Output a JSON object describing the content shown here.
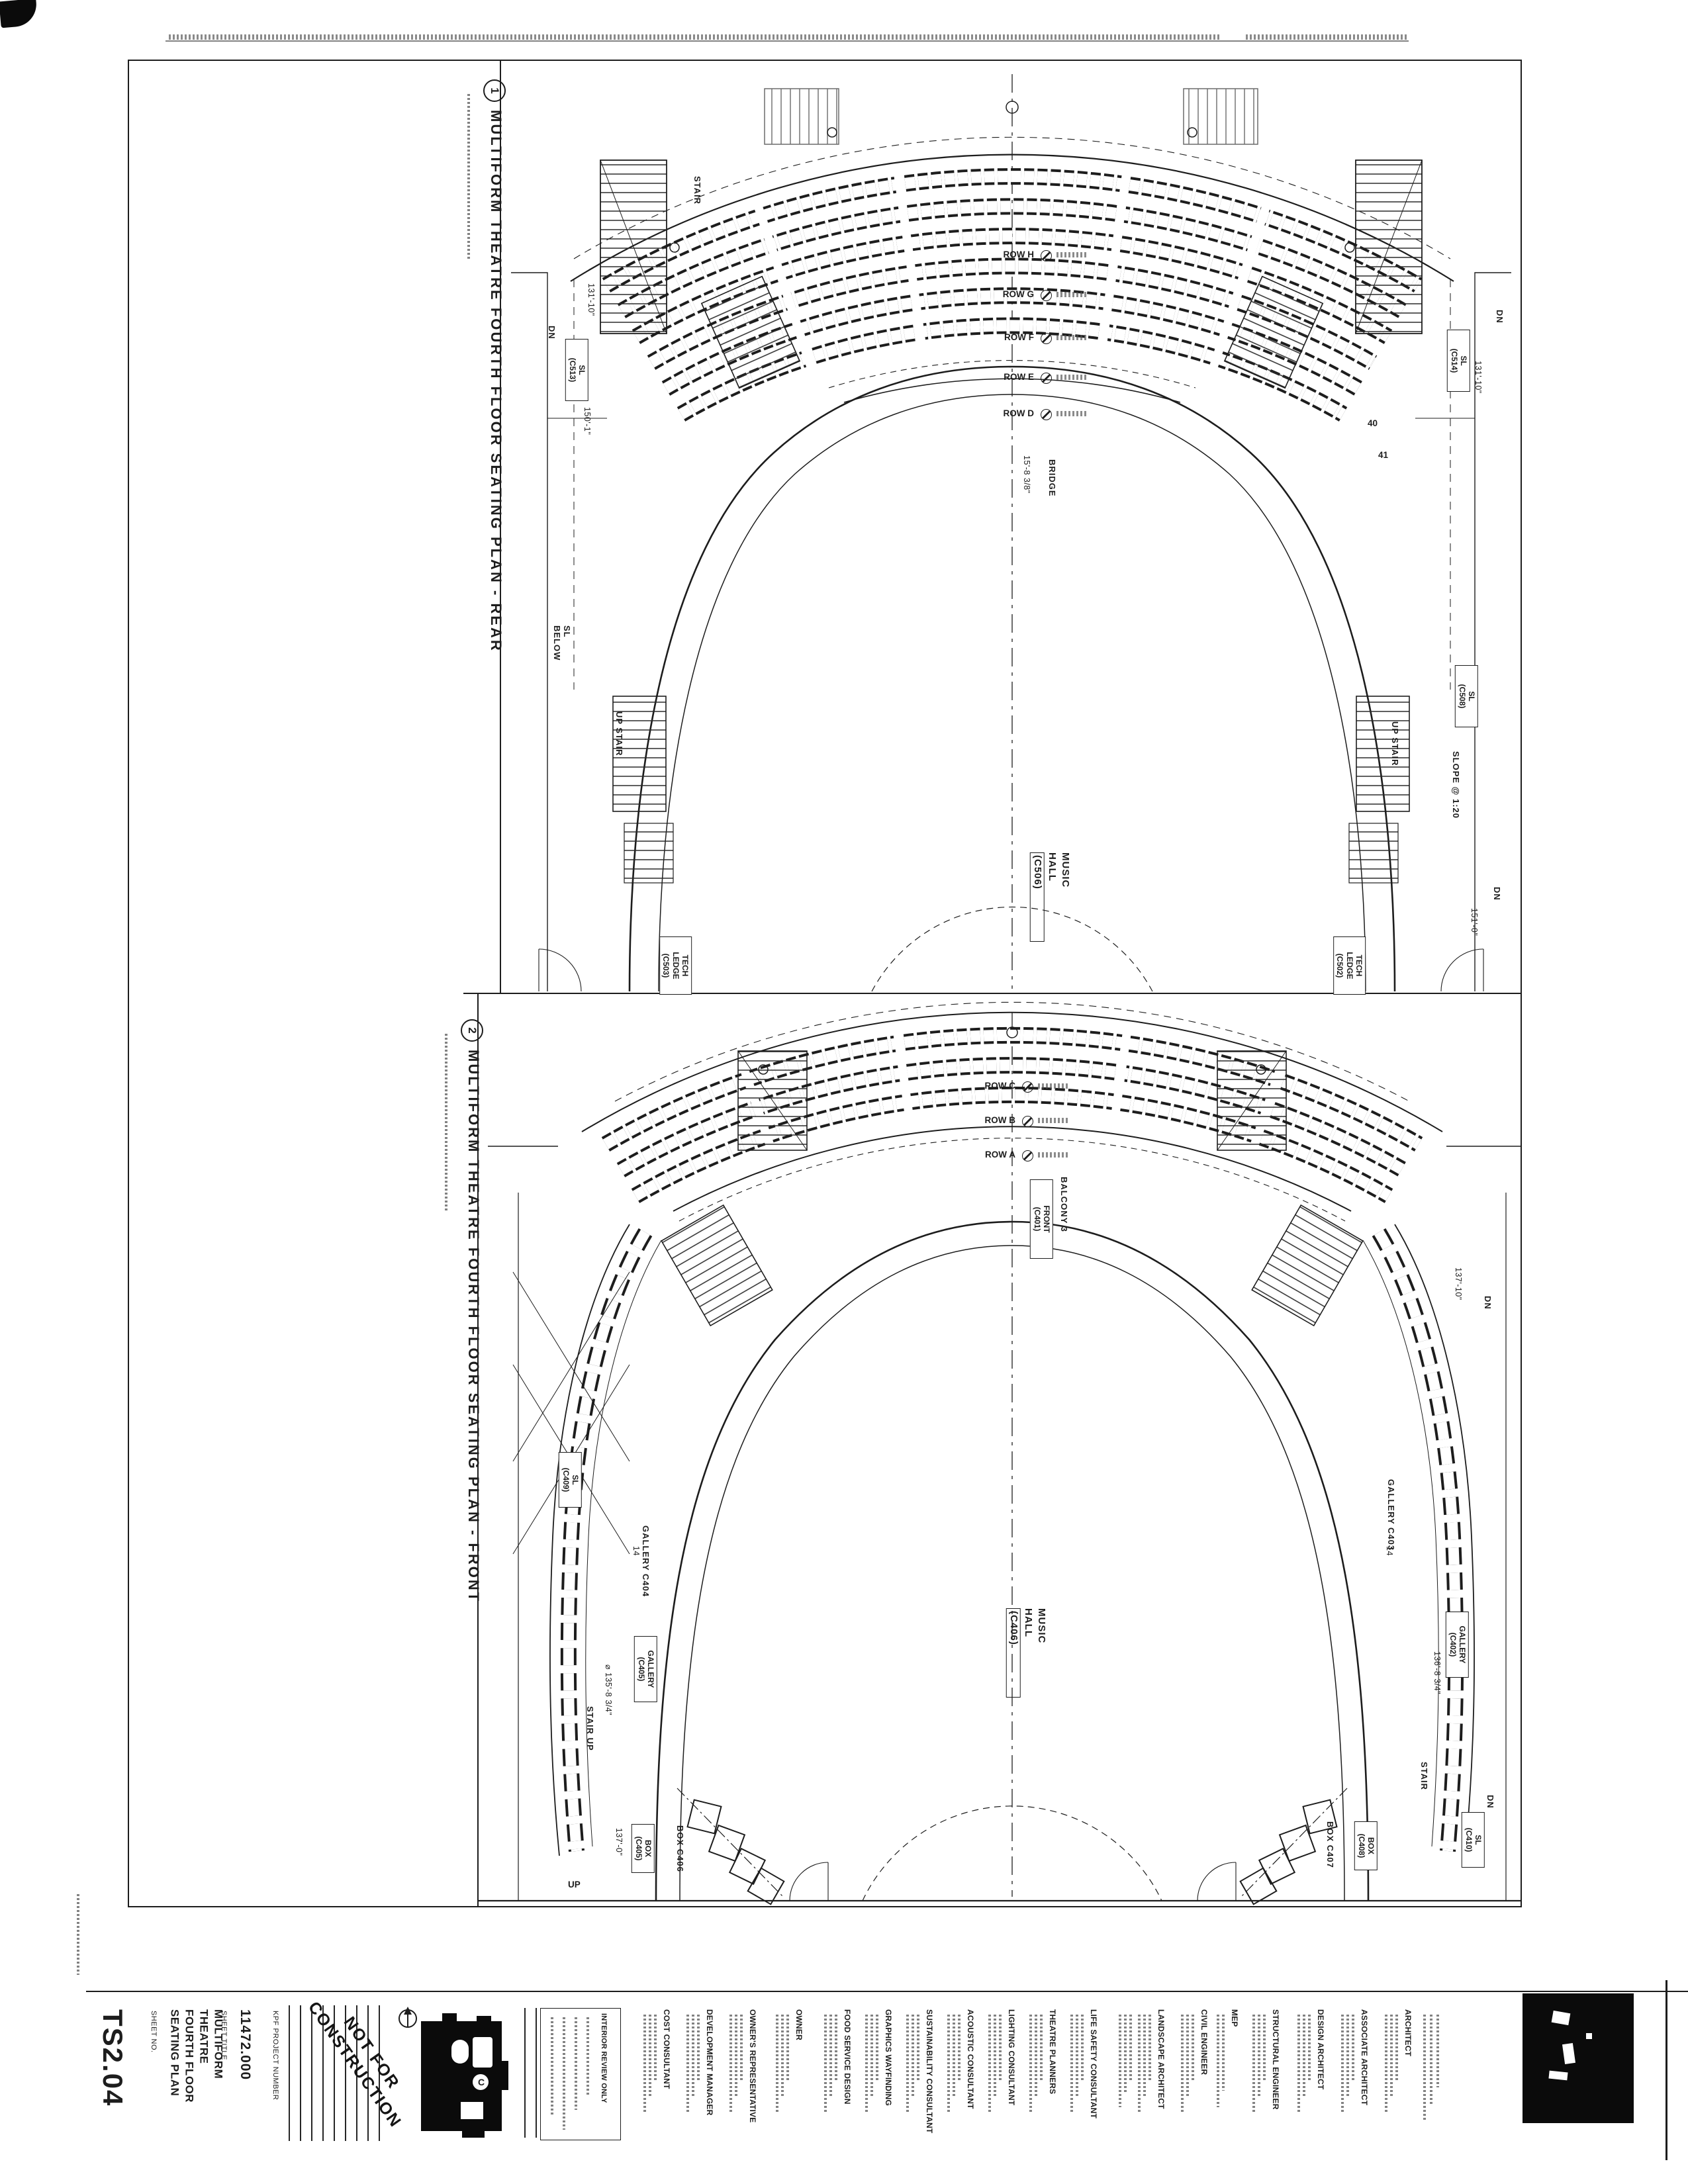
{
  "plans": [
    {
      "number": "1",
      "title": "MULTIFORM THEATRE FOURTH FLOOR SEATING PLAN - REAR",
      "rows": [
        "ROW H",
        "ROW G",
        "ROW F",
        "ROW E",
        "ROW D"
      ],
      "hall": [
        "MUSIC",
        "HALL",
        "(C506)"
      ],
      "labels": {
        "stair": "STAIR",
        "up_stair": "UP STAIR",
        "dn": "DN",
        "sl_below": [
          "SL",
          "BELOW"
        ],
        "bridge": "BRIDGE",
        "bridge_dim": "15'-8 3/8\"",
        "slope": "SLOPE @ 1:20",
        "dim_131_10": "131'-10\"",
        "dim_150_1": "150'-1\"",
        "dim_151_0": "151'-0\"",
        "seat_40": "40",
        "seat_41": "41"
      },
      "tags": {
        "sl_c513": [
          "SL",
          "(C513)"
        ],
        "sl_c514": [
          "SL",
          "(C514)"
        ],
        "sl_c508": [
          "SL",
          "(C508)"
        ],
        "tech_l": [
          "TECH",
          "LEDGE",
          "(C503)"
        ],
        "tech_r": [
          "TECH",
          "LEDGE",
          "(C502)"
        ]
      }
    },
    {
      "number": "2",
      "title": "MULTIFORM THEATRE FOURTH FLOOR SEATING PLAN - FRONT",
      "rows": [
        "ROW C",
        "ROW B",
        "ROW A"
      ],
      "hall": [
        "MUSIC",
        "HALL",
        "(C406)"
      ],
      "labels": {
        "balcony": "BALCONY 3",
        "gallery_l": "GALLERY C404",
        "gallery_r": "GALLERY C403",
        "box_l": "BOX C406",
        "box_r": "BOX C407",
        "stair": "STAIR",
        "stair_up": "STAIR UP",
        "up": "UP",
        "dn": "DN",
        "count_14": "14",
        "dim_137_10": "137'-10\"",
        "dim_136_8": "136'-8 3/4\"",
        "dim_135_8": "⌀ 135'-8 3/4\"",
        "dim_137_0": "137'-0\""
      },
      "tags": {
        "front": [
          "FRONT",
          "(C401)"
        ],
        "gal_l": [
          "GALLERY",
          "(C405)"
        ],
        "gal_r": [
          "GALLERY",
          "(C402)"
        ],
        "box_l": [
          "BOX",
          "(C405)"
        ],
        "box_r": [
          "BOX",
          "(C408)"
        ],
        "sl_409": [
          "SL",
          "(C409)"
        ],
        "sl_410": [
          "SL",
          "(C410)"
        ]
      }
    }
  ],
  "titleblock": {
    "sheet_no_label": "SHEET NO.",
    "sheet_number": "TS2.04",
    "sheet_title_label": "SHEET TITLE",
    "sheet_title_lines": [
      "MULTIFORM THEATRE",
      "FOURTH FLOOR",
      "SEATING PLAN"
    ],
    "project_number": "11472.000",
    "project_number_label": "KPF PROJECT NUMBER",
    "stamp_line1": "NOT FOR",
    "stamp_line2": "CONSTRUCTION",
    "interior_review": "INTERIOR REVIEW ONLY",
    "keyplan_letter": "C"
  },
  "consultants": [
    {
      "name": "COST CONSULTANT"
    },
    {
      "name": "DEVELOPMENT MANAGER"
    },
    {
      "name": "OWNER'S REPRESENTATIVE"
    },
    {
      "name": "OWNER"
    },
    {
      "name": "FOOD SERVICE DESIGN"
    },
    {
      "name": "GRAPHICS WAYFINDING"
    },
    {
      "name": "SUSTAINABILITY CONSULTANT"
    },
    {
      "name": "ACOUSTIC CONSULTANT"
    },
    {
      "name": "LIGHTING CONSULTANT"
    },
    {
      "name": "THEATRE PLANNERS"
    },
    {
      "name": "LIFE SAFETY CONSULTANT"
    },
    {
      "name": "LANDSCAPE ARCHITECT"
    },
    {
      "name": "CIVIL ENGINEER"
    },
    {
      "name": "MEP"
    },
    {
      "name": "STRUCTURAL ENGINEER"
    },
    {
      "name": "DESIGN ARCHITECT"
    },
    {
      "name": "ASSOCIATE ARCHITECT"
    },
    {
      "name": "ARCHITECT"
    }
  ]
}
